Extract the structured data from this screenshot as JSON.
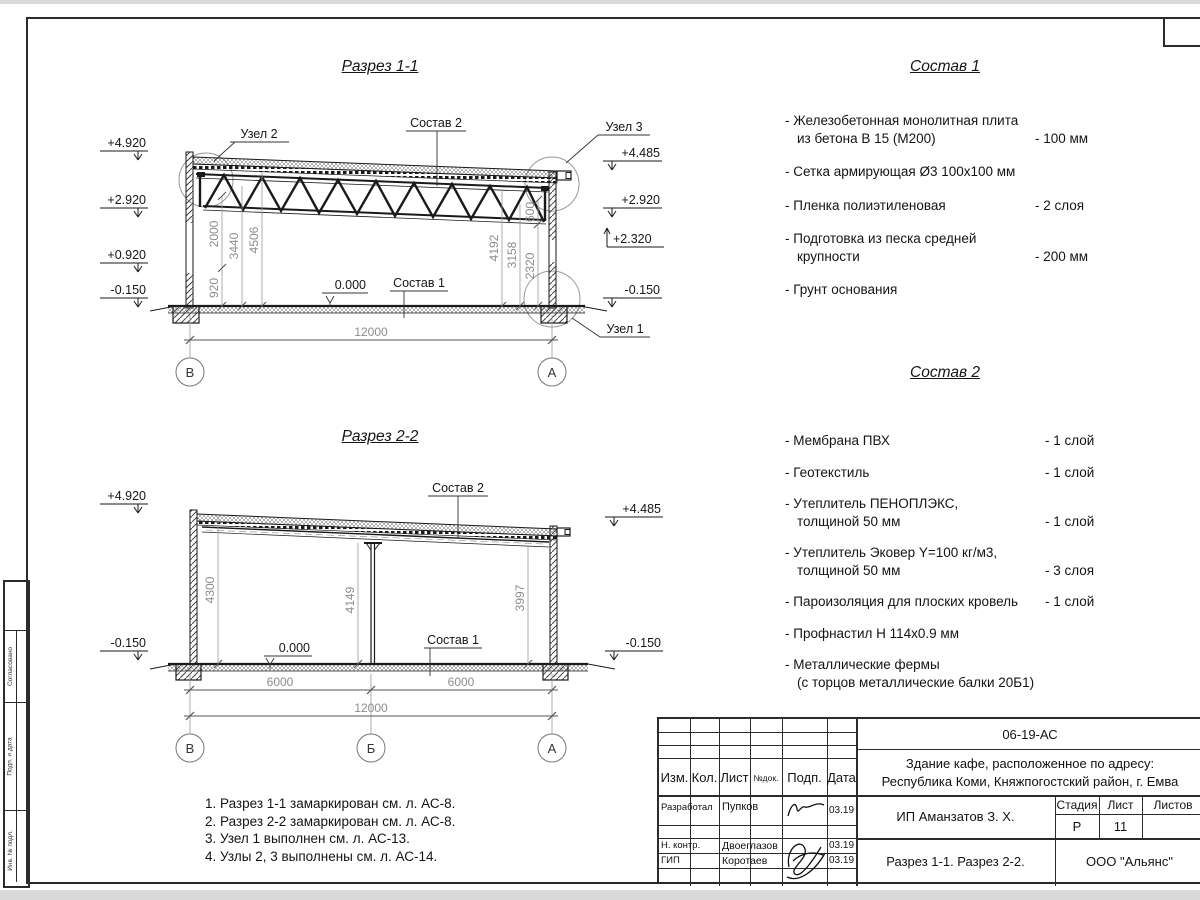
{
  "section1": {
    "title": "Разрез 1-1",
    "elev_left": [
      "+4.920",
      "+2.920",
      "+0.920",
      "-0.150"
    ],
    "elev_right": [
      "+4.485",
      "+2.920",
      "+2.320",
      "-0.150"
    ],
    "dims_left": [
      "2000",
      "920",
      "3440",
      "4506"
    ],
    "dims_right": [
      "600",
      "4192",
      "3158",
      "2320"
    ],
    "dim_total": "12000",
    "zero": "0.000",
    "label_sostav1": "Состав 1",
    "label_sostav2": "Состав 2",
    "label_uzel1": "Узел 1",
    "label_uzel2": "Узел 2",
    "label_uzel3": "Узел 3",
    "axes": [
      "В",
      "А"
    ]
  },
  "section2": {
    "title": "Разрез 2-2",
    "elev_left": [
      "+4.920",
      "-0.150"
    ],
    "elev_right": [
      "+4.485",
      "-0.150"
    ],
    "dims": [
      "4300",
      "4149",
      "3997"
    ],
    "spans": [
      "6000",
      "6000"
    ],
    "dim_total": "12000",
    "zero": "0.000",
    "label_sostav1": "Состав 1",
    "label_sostav2": "Состав 2",
    "axes": [
      "В",
      "Б",
      "А"
    ]
  },
  "sostav1": {
    "title": "Состав 1",
    "items": [
      {
        "name": "- Железобетонная монолитная плита\nиз бетона В 15 (М200)",
        "value": "- 100 мм"
      },
      {
        "name": "- Сетка армирующая Ø3 100х100 мм",
        "value": ""
      },
      {
        "name": "- Пленка полиэтиленовая",
        "value": "-  2 слоя"
      },
      {
        "name": "- Подготовка из песка средней\nкрупности",
        "value": "- 200 мм"
      },
      {
        "name": "- Грунт основания",
        "value": ""
      }
    ]
  },
  "sostav2": {
    "title": "Состав 2",
    "items": [
      {
        "name": "- Мембрана ПВХ",
        "value": "- 1 слой"
      },
      {
        "name": "- Геотекстиль",
        "value": "- 1 слой"
      },
      {
        "name": "- Утеплитель ПЕНОПЛЭКС,\nтолщиной 50 мм",
        "value": "- 1 слой"
      },
      {
        "name": "- Утеплитель Эковер Y=100 кг/м3,\nтолщиной 50 мм",
        "value": "- 3 слоя"
      },
      {
        "name": "- Пароизоляция для плоских кровель",
        "value": "- 1 слой"
      },
      {
        "name": "- Профнастил Н 114х0.9 мм",
        "value": ""
      },
      {
        "name": "- Металлические фермы\n(с торцов металлические балки 20Б1)",
        "value": ""
      }
    ]
  },
  "notes": {
    "lines": [
      "1. Разрез 1-1 замаркирован см. л. АС-8.",
      "2. Разрез 2-2 замаркирован см. л. АС-8.",
      "3. Узел 1 выполнен см. л. АС-13.",
      "4. Узлы 2, 3 выполнены см. л. АС-14."
    ]
  },
  "titleblock": {
    "doc_number": "06-19-АС",
    "project": [
      "Здание кафе, расположенное по адресу:",
      "Республика Коми, Княжпогостский район, г. Емва"
    ],
    "client": "ИП Аманзатов З. Х.",
    "sheet_title": "Разрез 1-1. Разрез 2-2.",
    "company": "ООО \"Альянс\"",
    "cols": [
      "Изм.",
      "Кол.",
      "Лист",
      "№док.",
      "Подп.",
      "Дата"
    ],
    "stage_cols": [
      "Стадия",
      "Лист",
      "Листов"
    ],
    "stage": "Р",
    "sheet": "11",
    "sheets": "",
    "rows": [
      {
        "role": "Разработал",
        "name": "Пупков",
        "date": "03.19"
      },
      {
        "role": "Н. контр.",
        "name": "Двоеглазов",
        "date": "03.19"
      },
      {
        "role": "ГИП",
        "name": "Коротаев",
        "date": "03.19"
      }
    ]
  },
  "side_stamp": {
    "labels": [
      "Согласовано",
      "Взам. инв. №",
      "Подп. и дата",
      "Инв. № подл."
    ]
  }
}
